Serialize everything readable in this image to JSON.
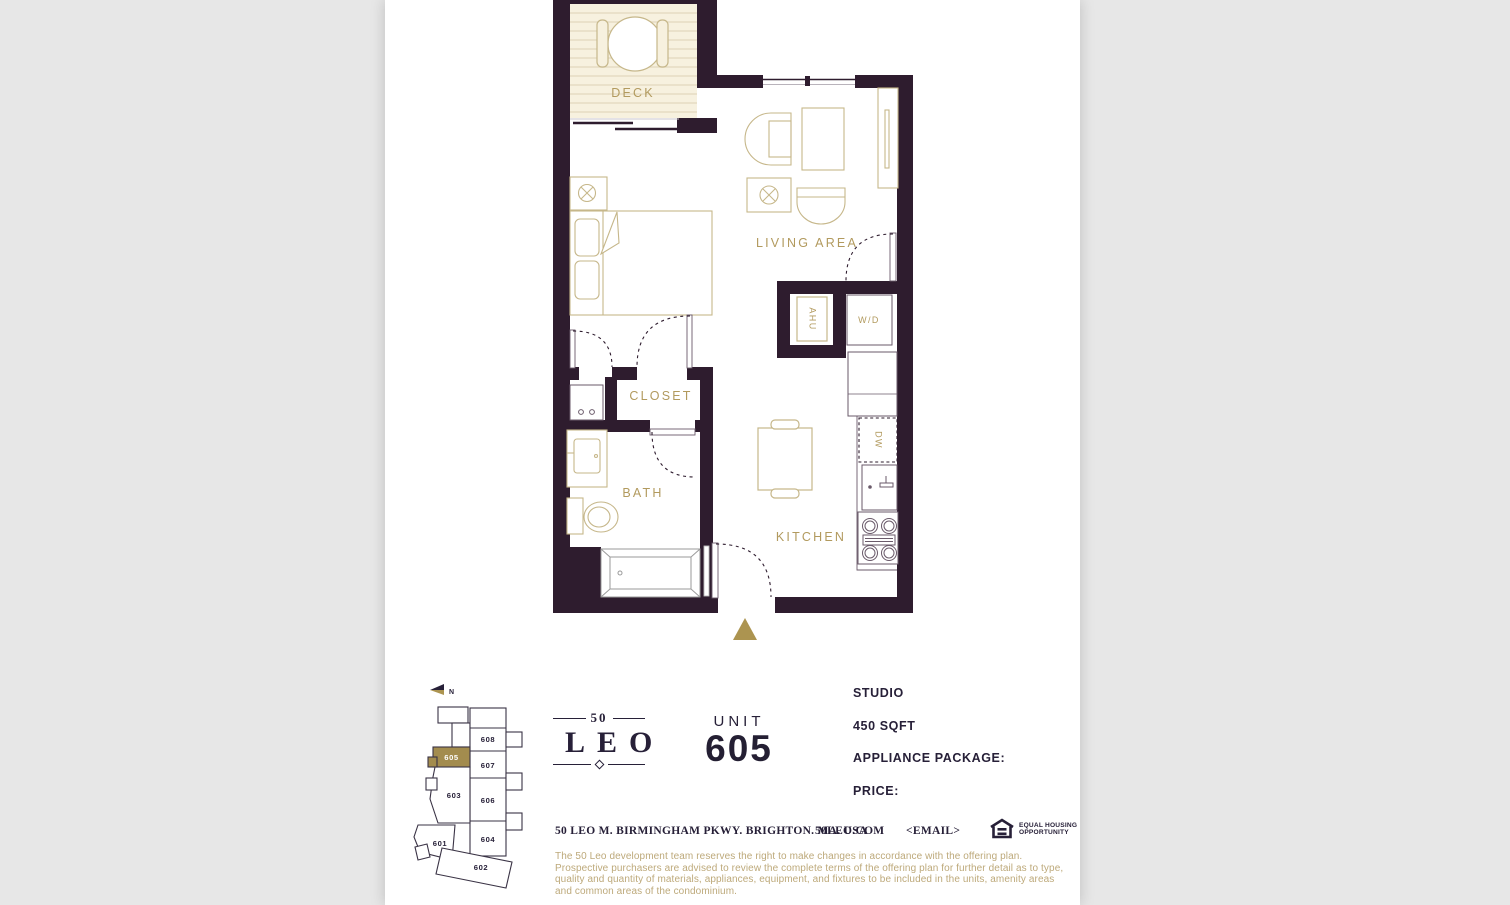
{
  "colors": {
    "page_background": "#e7e7e7",
    "paper": "#ffffff",
    "wall": "#2e1c2e",
    "furniture_line": "#c6b78a",
    "room_label_gold": "#b29a5e",
    "accent_gold": "#ac9450",
    "keyplan_highlight_gold": "#a38c4e",
    "text_navy": "#272038",
    "disclaimer_gold": "#bda97a",
    "deck_fill": "#f7f1df",
    "deck_stripe": "#e5dcc3"
  },
  "floorplan": {
    "rooms": {
      "deck": "DECK",
      "living_area": "LIVING AREA",
      "closet": "CLOSET",
      "bath": "BATH",
      "kitchen": "KITCHEN"
    },
    "fixtures": {
      "ahu": "AHU",
      "washer_dryer": "W/D",
      "dishwasher": "DW"
    }
  },
  "keyplan": {
    "north_label": "N",
    "highlighted_unit": "605",
    "units": {
      "u601": "601",
      "u602": "602",
      "u603": "603",
      "u604": "604",
      "u605": "605",
      "u606": "606",
      "u607": "607",
      "u608": "608"
    }
  },
  "logo": {
    "number": "50",
    "name": "LEO"
  },
  "unit": {
    "label": "UNIT",
    "number": "605"
  },
  "details": {
    "type": "STUDIO",
    "area": "450 SQFT",
    "appliance_label": "APPLIANCE PACKAGE:",
    "price_label": "PRICE:"
  },
  "footer": {
    "address": "50 LEO M. BIRMINGHAM PKWY. BRIGHTON. MA. USA",
    "website": "50LEO.COM",
    "email": "<EMAIL>",
    "eho_line1": "EQUAL HOUSING",
    "eho_line2": "OPPORTUNITY"
  },
  "disclaimer": {
    "text": "The 50 Leo development team reserves the right to make changes in accordance with the offering plan. Prospective purchasers are advised to review the complete terms of the offering plan for further detail as to type, quality and quantity of materials, appliances, equipment, and fixtures to be included in the units, amenity areas and common areas of the condominium."
  }
}
